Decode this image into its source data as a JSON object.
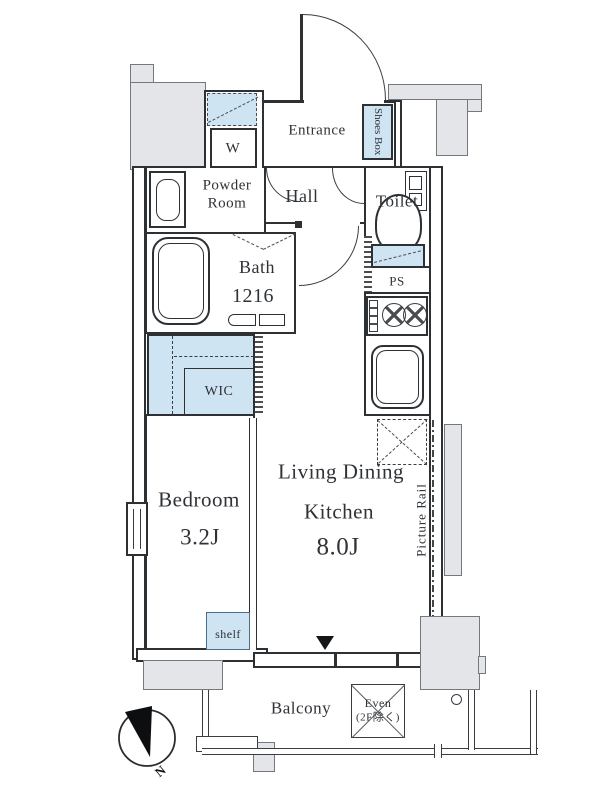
{
  "rooms": {
    "entrance": "Entrance",
    "shoes_box": "Shoes Box",
    "washer": "W",
    "powder_room": [
      "Powder",
      "Room"
    ],
    "hall": "Hall",
    "toilet": "Toilet",
    "bath": {
      "name": "Bath",
      "size": "1216"
    },
    "ps": "PS",
    "wic": "WIC",
    "bedroom": {
      "name": "Bedroom",
      "size": "3.2J"
    },
    "ldk": {
      "line1": "Living Dining",
      "line2": "Kitchen",
      "size": "8.0J"
    },
    "picture_rail": "Picture Rail",
    "shelf": "shelf",
    "balcony": {
      "name": "Balcony",
      "eaves_line1": "Even",
      "eaves_line2": "(2F除く)"
    },
    "compass_north": "N"
  },
  "colors": {
    "wall_fill": "#e3e5e8",
    "fixture_blue": "#cfe4f3",
    "line": "#2e3134"
  }
}
